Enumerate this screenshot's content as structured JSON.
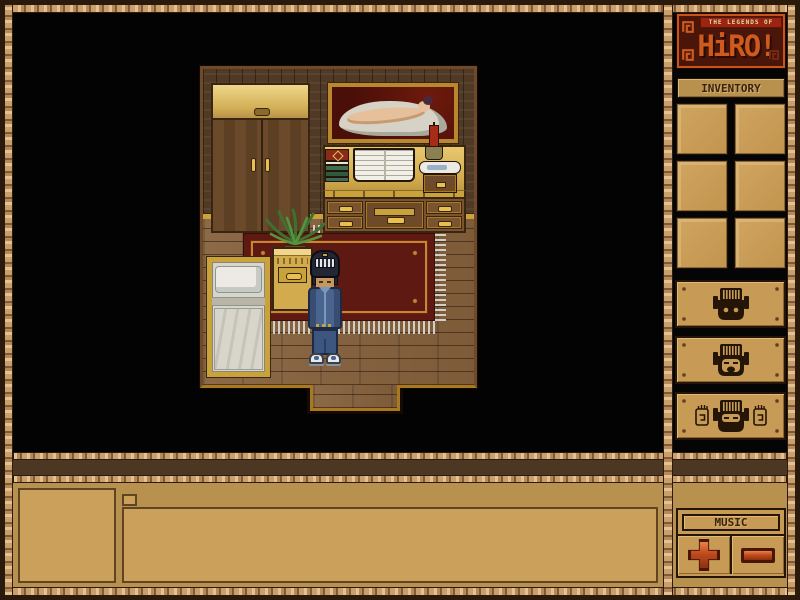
{
  "window": {
    "title": "The Legends of Hiro"
  },
  "logo": {
    "tagline": "THE LEGENDS OF",
    "title": "HiRO!"
  },
  "sidebar": {
    "inventory_label": "INVENTORY",
    "inventory_slots": [
      "empty",
      "empty",
      "empty",
      "empty",
      "empty",
      "empty"
    ],
    "action_buttons": [
      {
        "icon": "helmet-face-eyes-open-icon"
      },
      {
        "icon": "helmet-face-mouth-open-icon"
      },
      {
        "icon": "helmet-face-hands-icon"
      }
    ],
    "music": {
      "label": "MUSIC",
      "increase_icon": "plus",
      "decrease_icon": "minus"
    }
  },
  "console": {
    "portrait": "",
    "message": ""
  },
  "scene": {
    "room": "bedroom",
    "objects": [
      "wardrobe",
      "framed-painting",
      "candle",
      "desk",
      "stacked-books",
      "open-book",
      "bottle-on-chest",
      "potted-plant",
      "nightstand",
      "bed",
      "rug",
      "south-doorway"
    ],
    "player": {
      "description": "boy in blue jacket and jeans wearing dark helmet with white grille"
    }
  },
  "colors": {
    "frame_rope": "#c2955e",
    "frame_edge": "#2a1a0c",
    "panel_tan": "#b8914f",
    "box_tan": "#cba05a",
    "slot_tan": "#c79b56",
    "dark_border": "#241506",
    "band_brown": "#4c3722",
    "logo_orange": "#cf5a1e",
    "logo_bg": "#4a160a",
    "tagline_bg": "#9c2410",
    "tagline_text": "#d8e0a8",
    "button_red": "#c04a1e",
    "viewport_black": "#030303"
  }
}
